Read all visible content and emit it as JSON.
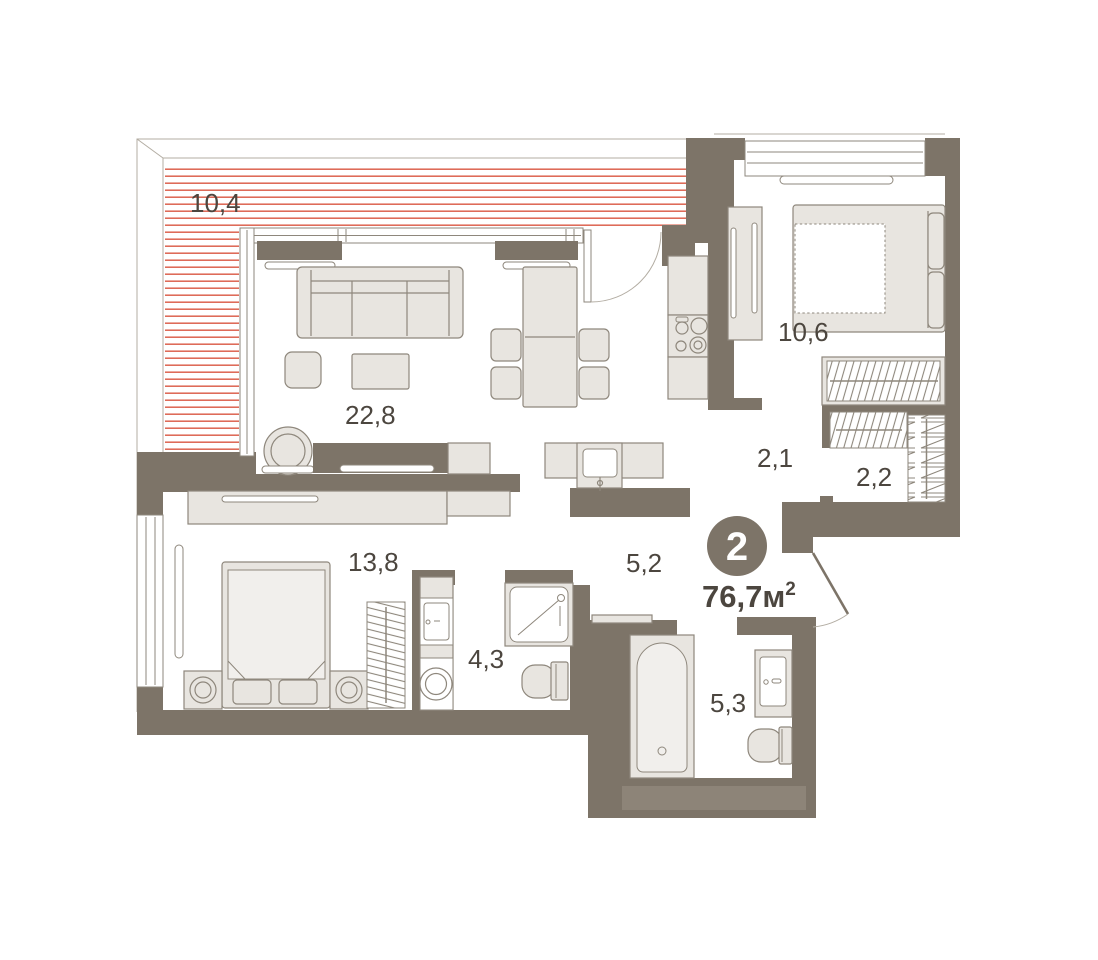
{
  "plan": {
    "badge_rooms": "2",
    "total_area": "76,7м",
    "total_area_sup": "2",
    "rooms": [
      {
        "name": "terrace",
        "area": "10,4"
      },
      {
        "name": "living-kitchen",
        "area": "22,8"
      },
      {
        "name": "bedroom",
        "area": "10,6"
      },
      {
        "name": "hallway",
        "area": "2,1"
      },
      {
        "name": "wardrobe",
        "area": "2,2"
      },
      {
        "name": "corridor",
        "area": "5,2"
      },
      {
        "name": "bedroom-2",
        "area": "13,8"
      },
      {
        "name": "shower-room",
        "area": "4,3"
      },
      {
        "name": "bathroom",
        "area": "5,3"
      }
    ]
  },
  "colors": {
    "paper": "#ffffff",
    "wall": "#7d7468",
    "wallLight": "#8d8478",
    "furn": "#e8e5e0",
    "stroke": "#8e877c",
    "thin": "#b3ada3",
    "stripe": "#dd6350",
    "text": "#4c463f"
  }
}
